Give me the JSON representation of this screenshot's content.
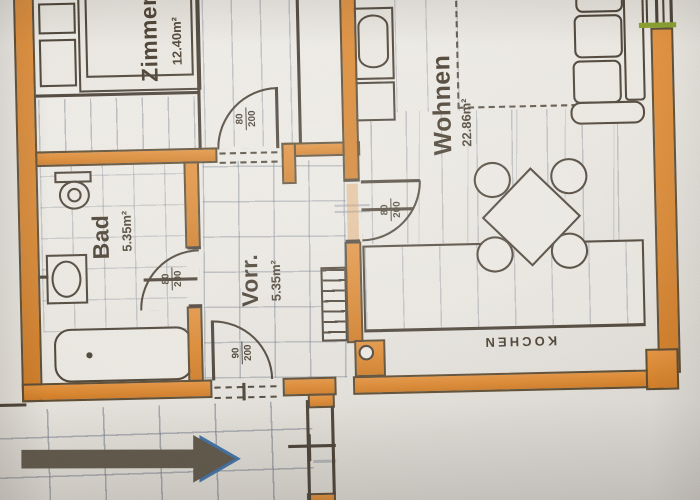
{
  "rooms": {
    "zimmer": {
      "name": "Zimmer",
      "area": "12.40m²"
    },
    "bad": {
      "name": "Bad",
      "area": "5.35m²"
    },
    "vorraum": {
      "name": "Vorr.",
      "area": "5.35m²"
    },
    "wohnen": {
      "name": "Wohnen",
      "area": "22.86m²"
    },
    "kueche": {
      "name": "KOCHEN"
    }
  },
  "doors": {
    "zimmer": {
      "width": "80",
      "height": "200"
    },
    "bad": {
      "width": "80",
      "height": "200"
    },
    "wohnen": {
      "width": "80",
      "height": "200"
    },
    "entrance": {
      "width": "90",
      "height": "200"
    }
  },
  "colors": {
    "wall_orange": "#d9862f",
    "plan_line": "#4a4136",
    "pencil_gray": "#8d94a0",
    "window_green": "#8aa32e",
    "arrow": "#5f584a",
    "arrow_tip_blue": "#3f72aa",
    "paper": "#e8e5df"
  }
}
